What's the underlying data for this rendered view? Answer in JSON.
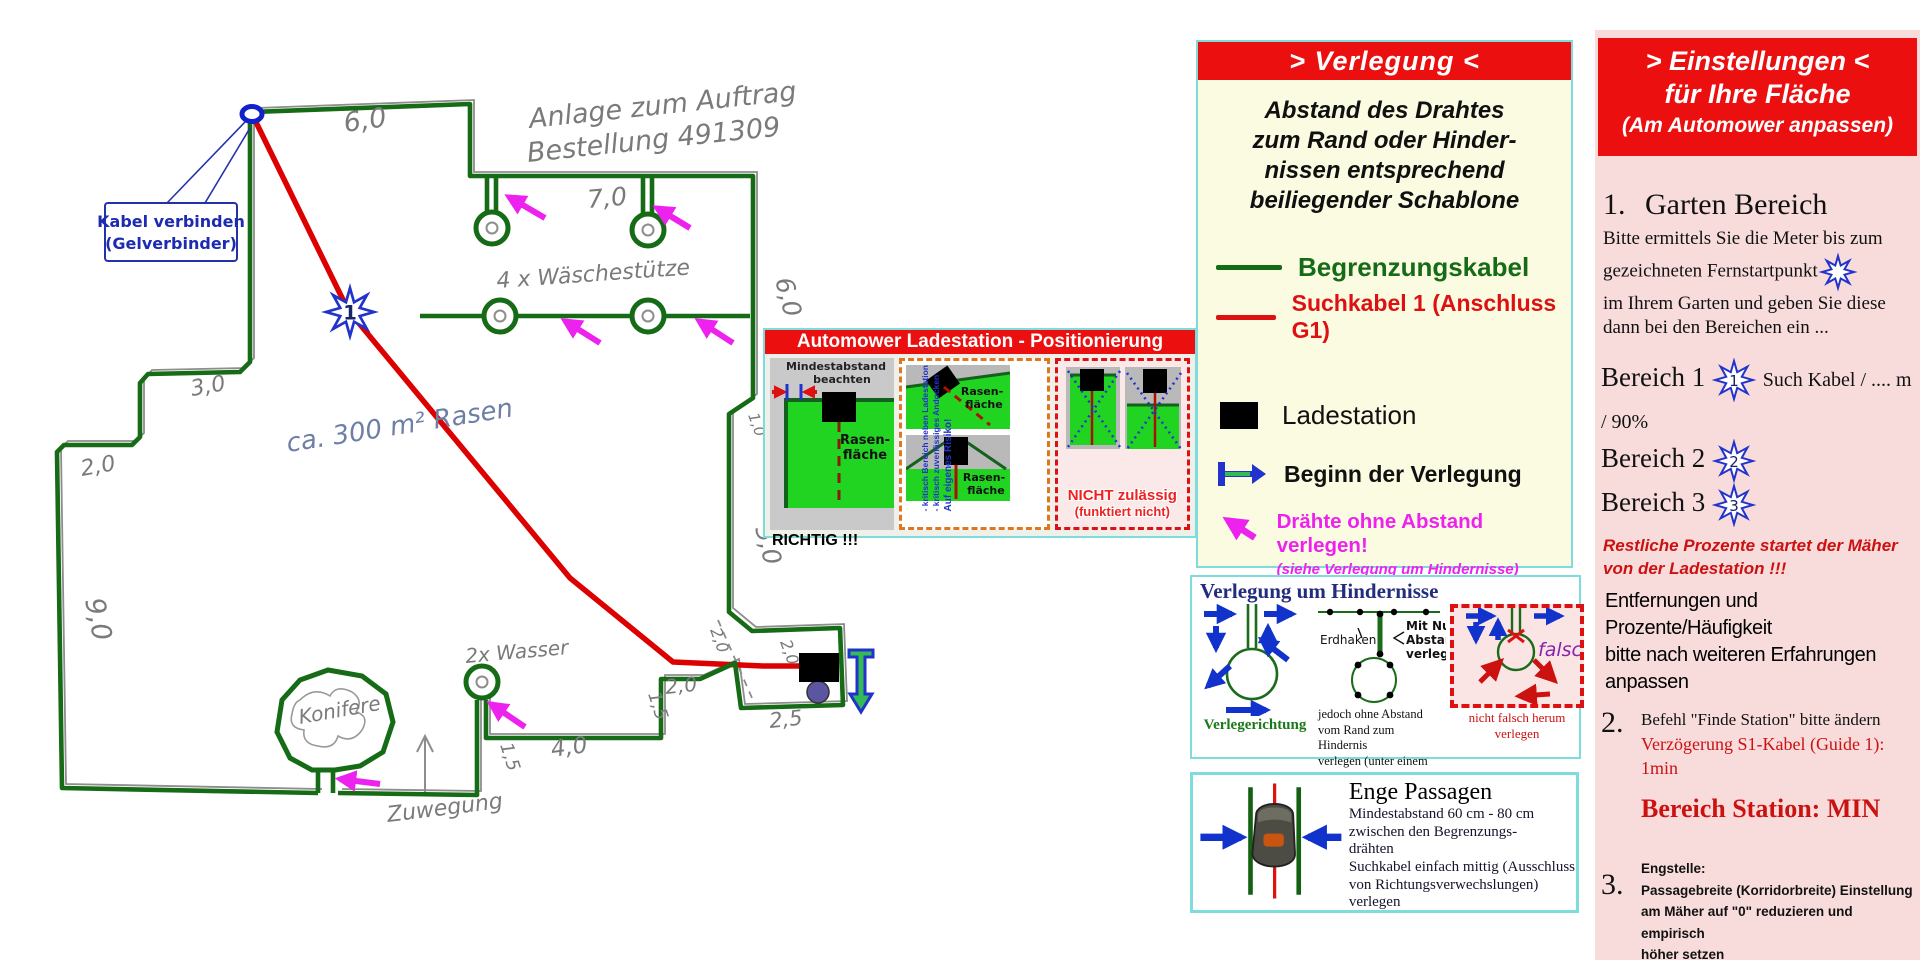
{
  "plan": {
    "order_note_line1": "Anlage zum Auftrag",
    "order_note_line2": "Bestellung 491309",
    "callout_line1": "Kabel verbinden",
    "callout_line2": "(Gelverbinder)",
    "area_note": "ca. 300 m² Rasen",
    "start_point_number": "1",
    "labels": {
      "clothesline": "4 x Wäschestütze",
      "water": "2x Wasser",
      "tree": "Konifere",
      "path": "Zuwegung"
    },
    "measurements": {
      "top": "6,0",
      "clothesline_top": "7,0",
      "right_upper": "6,0",
      "left_step_upper": "3,0",
      "left_step_lower": "2,0",
      "left_side": "9,0",
      "right_small": "1,0",
      "right_mid": "5,0",
      "passage_v1": "1,5",
      "passage_h": "4,0",
      "passage_v2": "1,5",
      "near_station_h": "2,0",
      "near_station_r1": "2,0",
      "near_station_r2": "2,0",
      "station_width": "2,5"
    }
  },
  "positioning_panel": {
    "title": "Automower Ladestation - Positionierung",
    "left": {
      "note_line1": "Mindestabstand",
      "note_line2": "beachten",
      "area_label_line1": "Rasen-",
      "area_label_line2": "fläche",
      "verdict": "RICHTIG !!!"
    },
    "middle": {
      "area_top_line1": "Rasen-",
      "area_top_line2": "fläche",
      "area_bottom_line1": "Rasen-",
      "area_bottom_line2": "fläche",
      "risk_line1": "Auf eigenes Risiko!",
      "risk_line2": "- kritisch zuverlässiges Andocken",
      "risk_line3": "- kritisch Bereich neben Ladestation"
    },
    "right": {
      "verdict_line1": "NICHT zulässig",
      "verdict_line2": "(funktiert nicht)"
    }
  },
  "verlegung_panel": {
    "title": "> Verlegung <",
    "intro_line1": "Abstand des Drahtes",
    "intro_line2": "zum Rand oder Hinder-",
    "intro_line3": "nissen entsprechend",
    "intro_line4": "beiliegender Schablone",
    "legend_boundary": "Begrenzungskabel",
    "legend_guide": "Suchkabel 1 (Anschluss G1)",
    "legend_station": "Ladestation",
    "legend_begin": "Beginn der Verlegung",
    "legend_nogap": "Drähte ohne Abstand verlegen!",
    "legend_nogap_sub": "(siehe Verlegung um Hindernisse)"
  },
  "hindernisse_panel": {
    "title": "Verlegung um Hindernisse",
    "left_caption": "Verlegerichtung",
    "erdhaken_label": "Erdhaken",
    "mit_null_line1": "Mit Null",
    "mit_null_line2": "Abstand",
    "mit_null_line3": "verlegen",
    "middle_caption_line1": "jedoch ohne Abstand",
    "middle_caption_line2": "vom Rand zum Hindernis",
    "middle_caption_line3": "verlegen (unter einem Haken)",
    "falsch_label": "falsch",
    "right_caption_line1": "nicht falsch herum",
    "right_caption_line2": "verlegen"
  },
  "passagen_panel": {
    "title": "Enge Passagen",
    "line1": "Mindestabstand 60 cm - 80 cm",
    "line2": "zwischen den Begrenzungs-",
    "line3": "drähten",
    "line4": "Suchkabel einfach mittig (Ausschluss",
    "line5": "von Richtungsverwechslungen) verlegen"
  },
  "settings_panel": {
    "title_line1": "> Einstellungen <",
    "title_line2": "für Ihre Fläche",
    "title_line3": "(Am Automower anpassen)",
    "item1_number": "1.",
    "item1_title": "Garten Bereich",
    "item1_line1": "Bitte ermittels Sie die Meter bis zum",
    "item1_line2": "gezeichneten Fernstartpunkt",
    "item1_line3": "im Ihrem Garten und geben Sie diese",
    "item1_line4": "dann bei den Bereichen ein ...",
    "bereich1_label": "Bereich 1",
    "bereich1_value": "Such Kabel / .... m / 90%",
    "bereich2_label": "Bereich 2",
    "bereich3_label": "Bereich 3",
    "star1": "1",
    "star2": "2",
    "star3": "3",
    "warning_line1": "Restliche Prozente  startet der Mäher",
    "warning_line2": "von der Ladestation !!!",
    "note_line1": "Entfernungen und Prozente/Häufigkeit",
    "note_line2": "bitte nach weiteren Erfahrungen anpassen",
    "item2_number": "2.",
    "item2_line1": "Befehl \"Finde Station\" bitte ändern",
    "item2_line2": "Verzögerung S1-Kabel (Guide 1): 1min",
    "station_setting": "Bereich Station: MIN",
    "item3_number": "3.",
    "item3_line1": "Engstelle:",
    "item3_line2": "Passagebreite (Korridorbreite) Einstellung",
    "item3_line3": "am Mäher auf \"0\" reduzieren und empirisch",
    "item3_line4": "höher setzen"
  },
  "colors": {
    "boundary_cable": "#166b16",
    "guide_cable": "#dd0000",
    "no_gap_arrow": "#ee22ee",
    "header_red": "#ec0f0f",
    "settings_pink": "#f8dcdc",
    "legend_cream": "#fbfbe2",
    "panel_border_cyan": "#7fdcdc"
  }
}
